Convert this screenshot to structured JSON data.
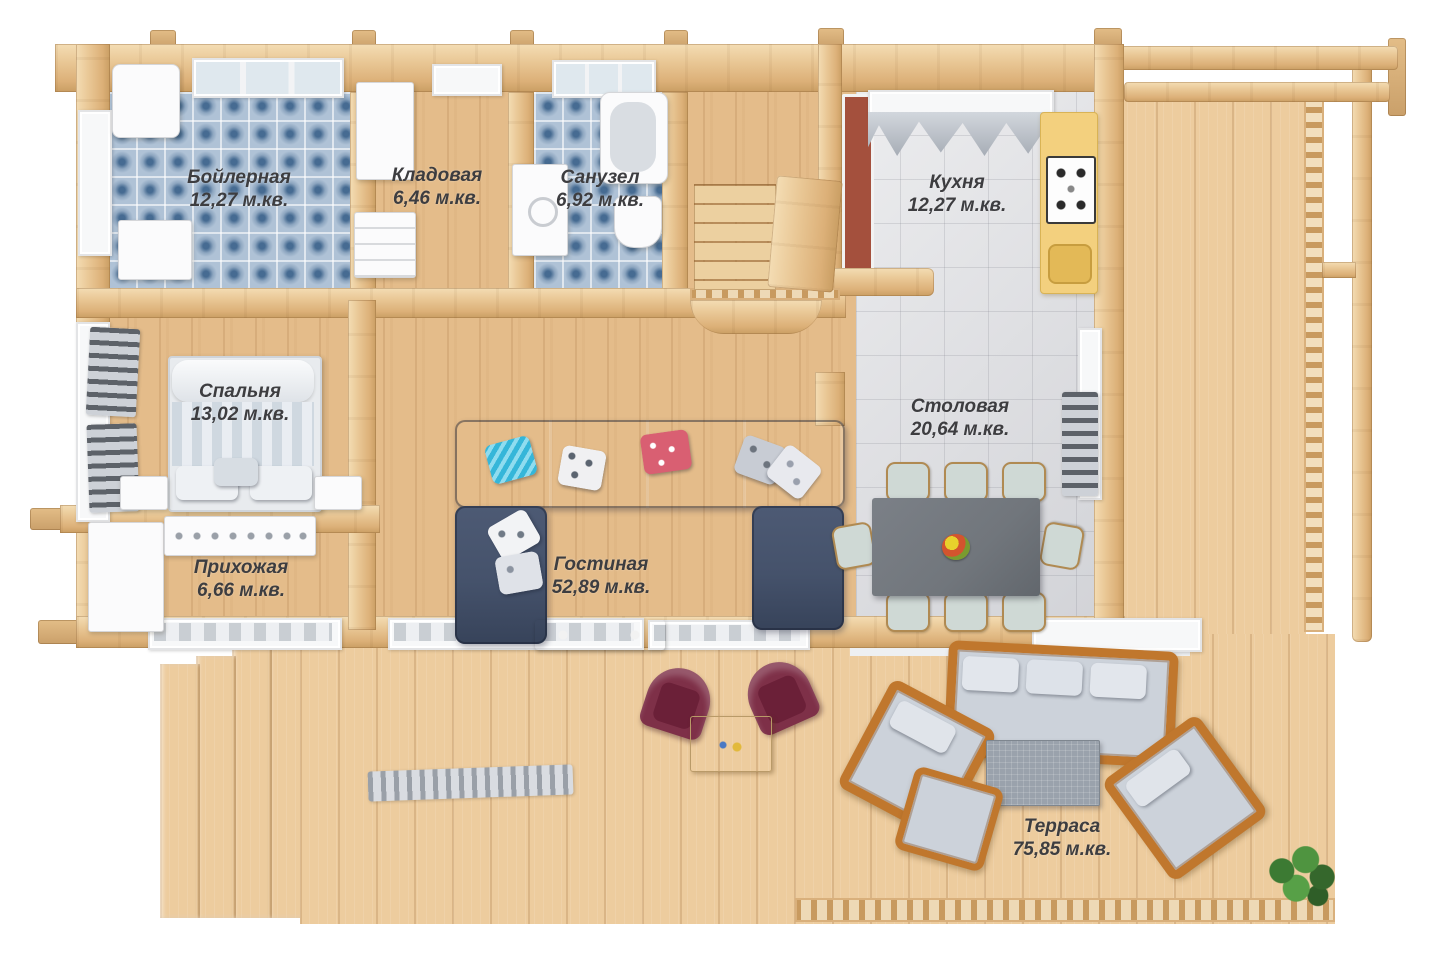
{
  "colors": {
    "background": "#ffffff",
    "wall": "#e8c592",
    "floor": "#e4bc8a",
    "deck": "#edcc9e",
    "tileBlue": "#afc2d6",
    "tileGray": "#d9dade",
    "sofaNavy": "#45526b",
    "burgundy": "#7e3048",
    "wicker": "#c0772d",
    "cushionGray": "#ccd2da",
    "tableDark": "#71767c",
    "counterYellow": "#f3d07e",
    "chimneyRed": "#a4503d",
    "labelText": "#3d3d40"
  },
  "rooms": {
    "boiler": {
      "name": "Бойлерная",
      "area": "12,27 м.кв."
    },
    "storage": {
      "name": "Кладовая",
      "area": "6,46 м.кв."
    },
    "bathroom": {
      "name": "Санузел",
      "area": "6,92 м.кв."
    },
    "kitchen": {
      "name": "Кухня",
      "area": "12,27 м.кв."
    },
    "bedroom": {
      "name": "Спальня",
      "area": "13,02 м.кв."
    },
    "dining": {
      "name": "Столовая",
      "area": "20,64 м.кв."
    },
    "hallway": {
      "name": "Прихожая",
      "area": "6,66 м.кв."
    },
    "living": {
      "name": "Гостиная",
      "area": "52,89 м.кв."
    },
    "terrace": {
      "name": "Терраса",
      "area": "75,85 м.кв."
    }
  }
}
